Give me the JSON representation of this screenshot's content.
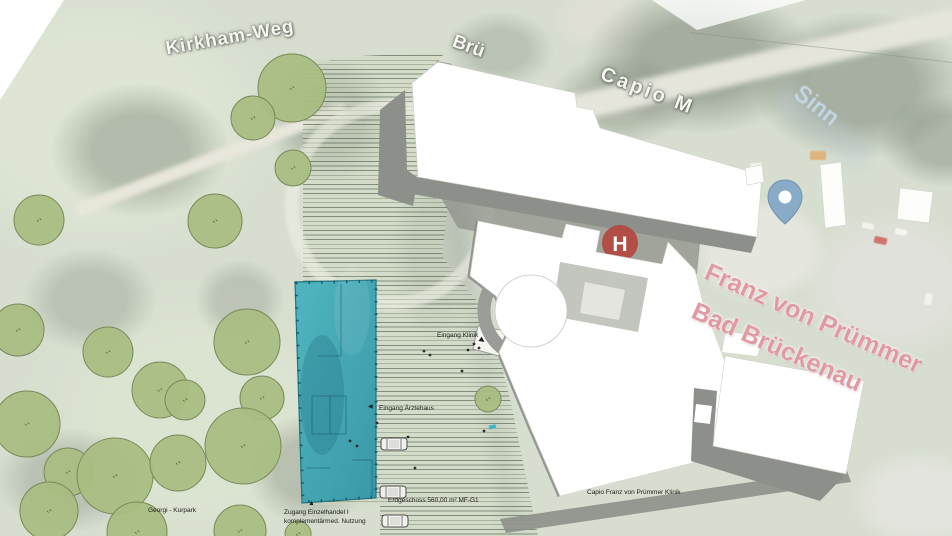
{
  "map": {
    "street_labels": {
      "kirkham_weg": "Kirkham-Weg",
      "bruecke_fragment": "Brü",
      "capio_fragment": "Capio M",
      "river_sinn": "Sinn",
      "clinic_name_line1": "Franz von Prümmer",
      "clinic_name_line2": "Bad Brückenau",
      "hospital_marker_letter": "H",
      "hospital_marker_fragment": "K"
    },
    "annotations": {
      "entrance_clinic": "Eingang Klinik",
      "entrance_doctors_house": "Eingang Ärztehaus",
      "access_retail_line1": "Zugang Einzelhandel I",
      "access_retail_line2": "komplementärmed. Nutzung",
      "ground_floor_area": "Erdgeschoss 560,00 m² MF-G1",
      "park_name": "Georgi - Kurpark",
      "clinic_building_label": "Capio Franz von Prümmer Klinik"
    },
    "icons": {
      "arrow_entrance_clinic": "▶",
      "arrow_entrance_doctors_house": "◀",
      "arrow_access_retail": "▲"
    }
  },
  "colors": {
    "new_building_teal": "#35a3b2",
    "tree_fill": "#a9bd82",
    "tree_stroke": "#79895a",
    "building_white": "#ffffff",
    "shadow_gray": "#8d908a",
    "street_label_white": "#f7f7f0",
    "street_label_pink": "#e09aa2",
    "river_blue": "#c3d9e9",
    "hospital_red": "#b4423a",
    "map_pin_blue": "#88abc8"
  },
  "trees": [
    {
      "x": 292,
      "y": 88,
      "r": 34
    },
    {
      "x": 253,
      "y": 118,
      "r": 22
    },
    {
      "x": 293,
      "y": 168,
      "r": 18
    },
    {
      "x": 215,
      "y": 221,
      "r": 27
    },
    {
      "x": 39,
      "y": 220,
      "r": 25
    },
    {
      "x": 18,
      "y": 330,
      "r": 26
    },
    {
      "x": 108,
      "y": 352,
      "r": 25
    },
    {
      "x": 160,
      "y": 390,
      "r": 28
    },
    {
      "x": 247,
      "y": 342,
      "r": 33
    },
    {
      "x": 262,
      "y": 398,
      "r": 22
    },
    {
      "x": 27,
      "y": 424,
      "r": 33
    },
    {
      "x": 68,
      "y": 472,
      "r": 24
    },
    {
      "x": 115,
      "y": 476,
      "r": 38
    },
    {
      "x": 49,
      "y": 511,
      "r": 29
    },
    {
      "x": 185,
      "y": 400,
      "r": 20
    },
    {
      "x": 178,
      "y": 463,
      "r": 28
    },
    {
      "x": 243,
      "y": 446,
      "r": 38
    },
    {
      "x": 137,
      "y": 532,
      "r": 30
    },
    {
      "x": 240,
      "y": 531,
      "r": 26
    },
    {
      "x": 488,
      "y": 399,
      "r": 13
    },
    {
      "x": 298,
      "y": 534,
      "r": 13
    }
  ],
  "cars": [
    {
      "x": 394,
      "y": 444
    },
    {
      "x": 393,
      "y": 492
    },
    {
      "x": 395,
      "y": 521
    }
  ],
  "people_dots": [
    [
      474,
      344
    ],
    [
      479,
      348
    ],
    [
      468,
      350
    ],
    [
      424,
      351
    ],
    [
      430,
      355
    ],
    [
      350,
      441
    ],
    [
      357,
      446
    ],
    [
      462,
      371
    ],
    [
      484,
      431
    ],
    [
      377,
      423
    ],
    [
      408,
      437
    ],
    [
      415,
      468
    ]
  ]
}
